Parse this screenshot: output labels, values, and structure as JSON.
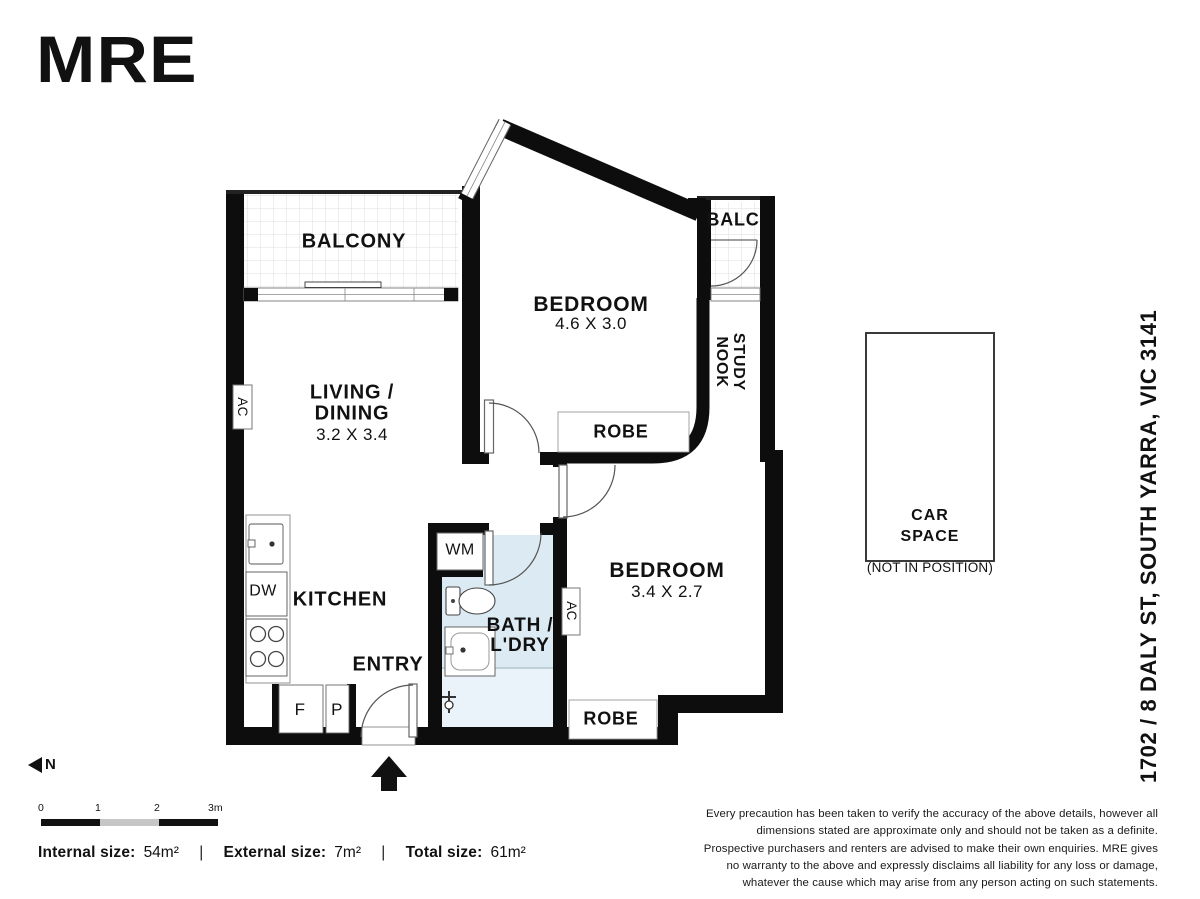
{
  "brand": {
    "logo_text": "MRE"
  },
  "plan": {
    "rooms": {
      "balcony": {
        "label": "BALCONY"
      },
      "bedroom1": {
        "label": "BEDROOM",
        "dimensions": "4.6 X 3.0"
      },
      "balc": {
        "label": "BALC"
      },
      "study_nook": {
        "line1": "STUDY",
        "line2": "NOOK"
      },
      "living_dining": {
        "line1": "LIVING /",
        "line2": "DINING",
        "dimensions": "3.2 X 3.4"
      },
      "kitchen": {
        "label": "KITCHEN"
      },
      "entry": {
        "label": "ENTRY"
      },
      "bath_laundry": {
        "line1": "BATH /",
        "line2": "L'DRY"
      },
      "bedroom2": {
        "label": "BEDROOM",
        "dimensions": "3.4 X 2.7"
      },
      "robe1": {
        "label": "ROBE"
      },
      "robe2": {
        "label": "ROBE"
      }
    },
    "fixtures": {
      "washing_machine": "WM",
      "dishwasher": "DW",
      "fridge": "F",
      "pantry": "P",
      "ac_living": "AC",
      "ac_bedroom2": "AC"
    },
    "car_space": {
      "line1": "CAR",
      "line2": "SPACE",
      "note": "(NOT IN POSITION)"
    }
  },
  "annotations": {
    "address": "1702 / 8 DALY ST, SOUTH YARRA, VIC 3141",
    "north_label": "N",
    "scale_ticks": [
      "0",
      "1",
      "2",
      "3m"
    ],
    "sizes": {
      "internal_label": "Internal size:",
      "internal_value": "54m²",
      "external_label": "External size:",
      "external_value": "7m²",
      "total_label": "Total size:",
      "total_value": "61m²",
      "separator": "|"
    },
    "disclaimer": "Every precaution has been taken to verify the accuracy of the above details, however all dimensions stated are approximate only and should not be taken as a definite. Prospective purchasers and renters are advised to make their own enquiries. MRE gives no warranty to the above and expressly disclaims all liability for any loss or damage, whatever the cause which may arise from any person acting on such statements."
  },
  "colors": {
    "wall": "#0d0d0d",
    "bath_fill": "#dcebf3",
    "shower_fill": "#e9f3f9",
    "scale_gray": "#c6c6c6",
    "tile_line": "#dedede"
  }
}
